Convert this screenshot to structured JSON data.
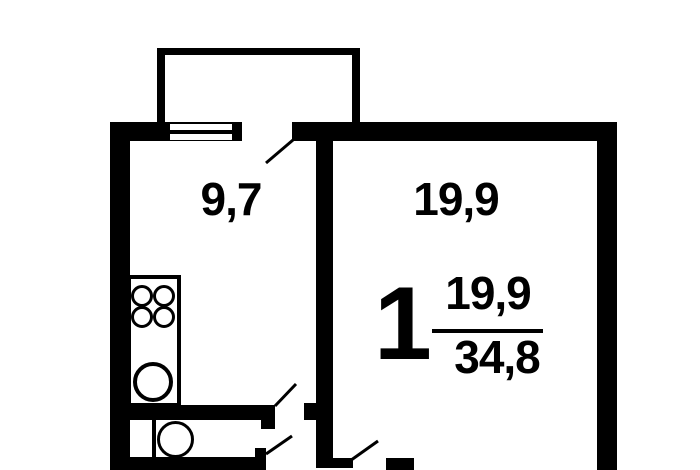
{
  "canvas": {
    "background_color": "#ffffff",
    "line_color": "#000000",
    "width": 700,
    "height": 470
  },
  "plan": {
    "type": "apartment-floor-plan",
    "rooms": [
      {
        "id": "kitchen",
        "area_label": "9,7"
      },
      {
        "id": "living-room",
        "area_label": "19,9"
      }
    ],
    "summary": {
      "rooms_count": "1",
      "living_area": "19,9",
      "total_area": "34,8"
    },
    "fixtures": [
      "balcony",
      "window",
      "balcony-door",
      "stove-4-burner",
      "kitchen-sink",
      "toilet",
      "door-swing-arcs"
    ]
  }
}
